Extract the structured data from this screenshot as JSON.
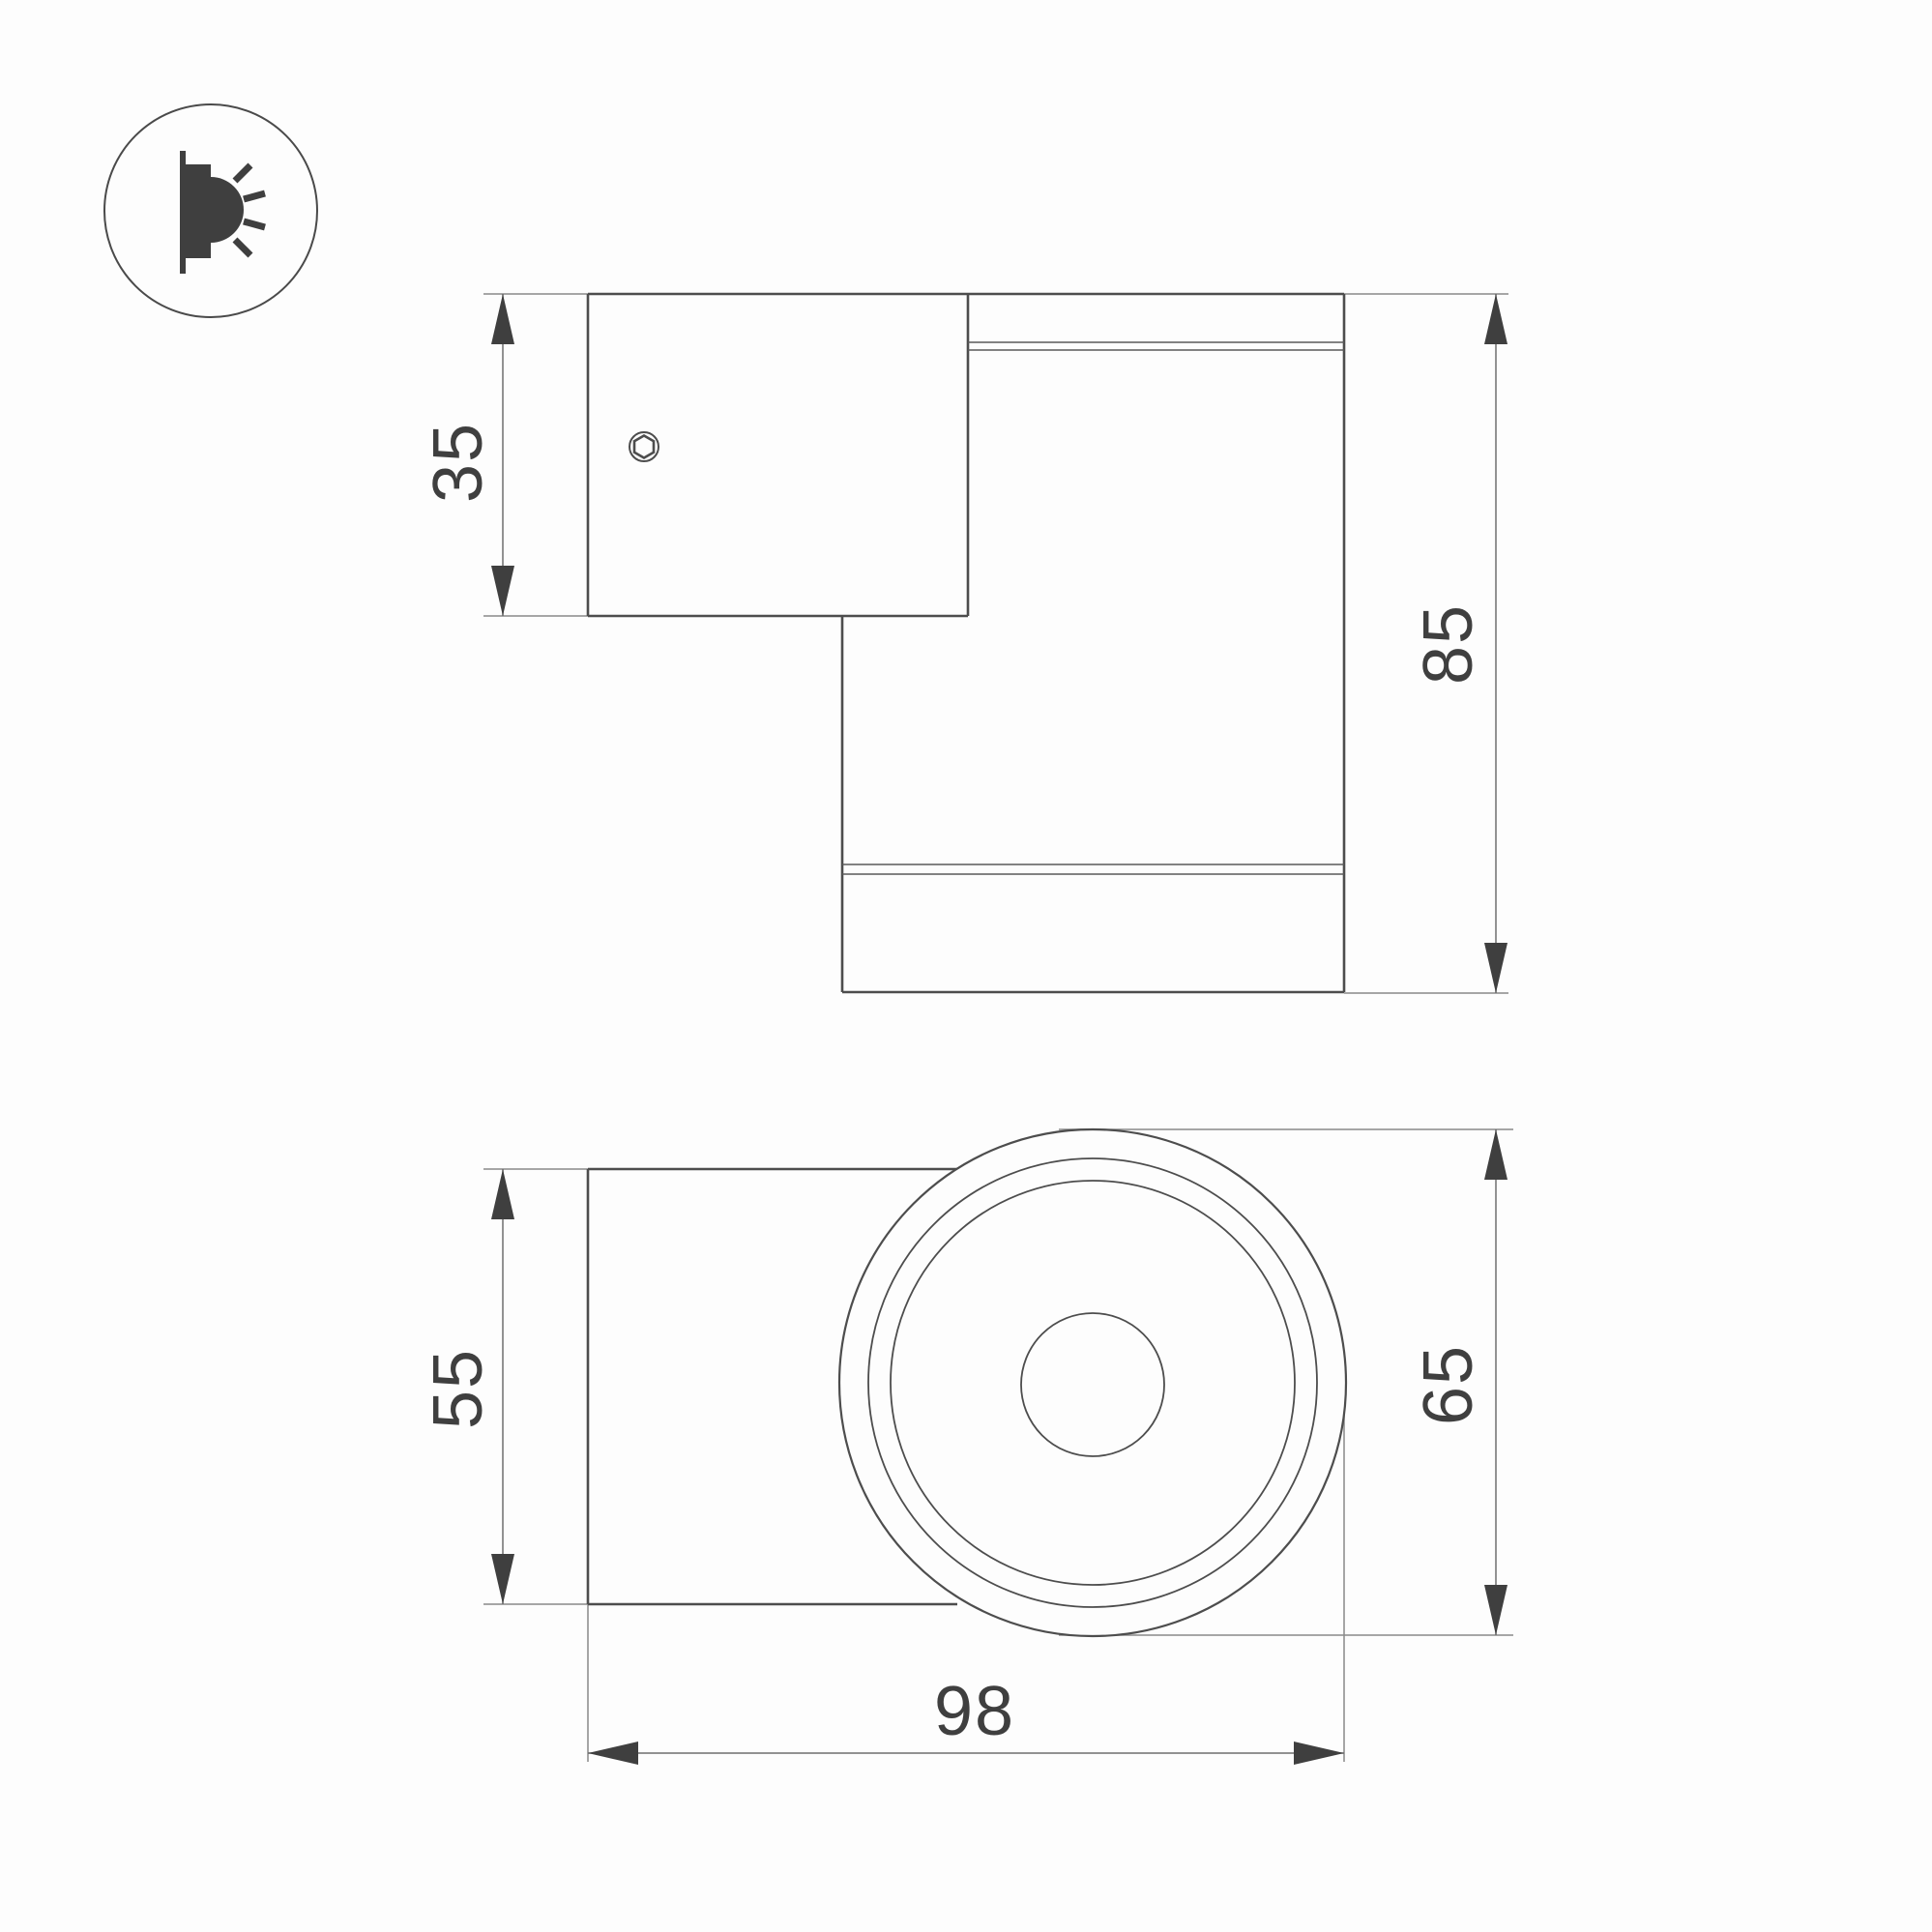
{
  "page": {
    "background_color": "#fdfdfd",
    "line_color": "#4d4d4d",
    "extension_line_color": "#8a8a8a",
    "text_color": "#3f3f3f"
  },
  "icon": {
    "name": "wall-mounted-light-icon"
  },
  "drawing": {
    "type": "technical-dimension-drawing",
    "views": {
      "side_view": {
        "dimensions": {
          "plate_height": "35",
          "overall_height": "85"
        }
      },
      "front_view": {
        "dimensions": {
          "plate_width": "55",
          "body_diameter": "65",
          "overall_depth": "98"
        }
      }
    }
  }
}
